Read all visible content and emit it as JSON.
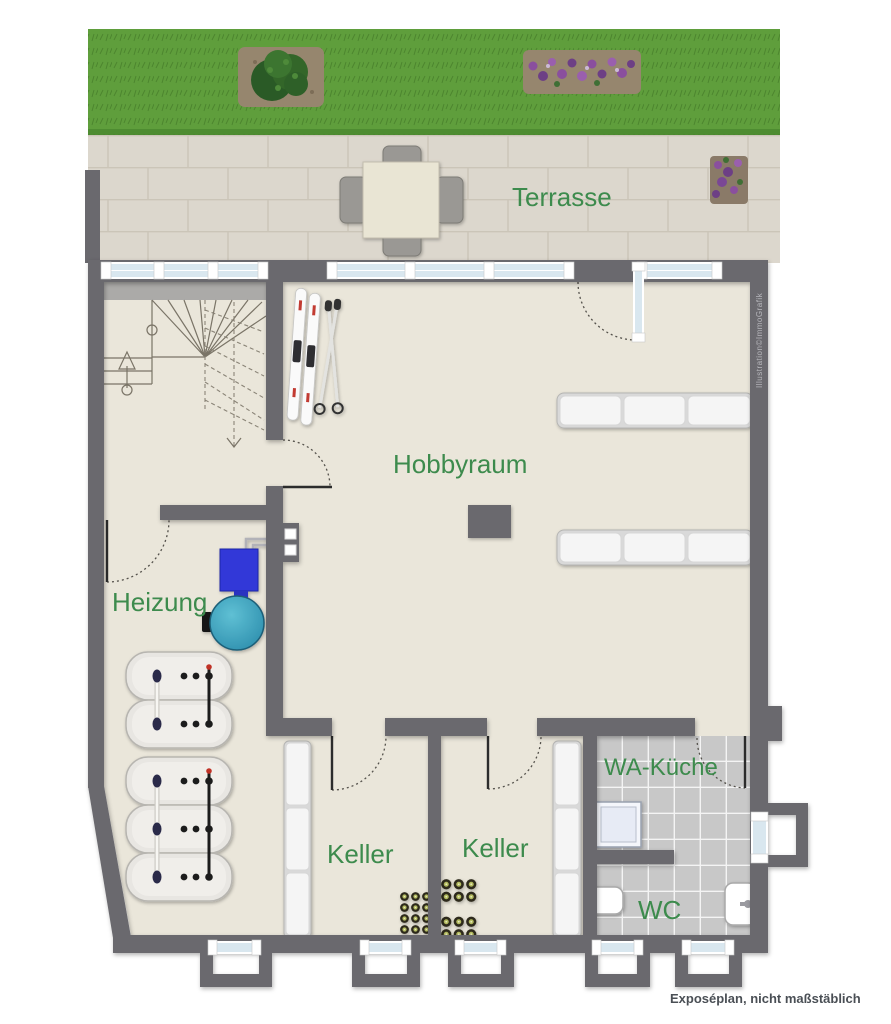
{
  "rooms": {
    "terrasse": {
      "label": "Terrasse"
    },
    "hobbyraum": {
      "label": "Hobbyraum"
    },
    "heizung": {
      "label": "Heizung"
    },
    "keller1": {
      "label": "Keller"
    },
    "keller2": {
      "label": "Keller"
    },
    "wakueche": {
      "label": "WA-Küche"
    },
    "wc": {
      "label": "WC"
    }
  },
  "annotations": {
    "credit": "Illustration©ImmoGrafik",
    "disclaimer": "Exposéplan, nicht maßstäblich"
  },
  "colors": {
    "wall": "#6a696e",
    "floor": "#eae6da",
    "room_label": "#3d8b4d",
    "lawn": "#5f9e3c",
    "paving": "#dcd7cd",
    "tile": "#c8c8c8",
    "window_glass": "#d9e7ef",
    "boiler_blue": "#3038d8",
    "tank_teal": "#2e8fae",
    "annotation_gray": "#4a4f55"
  }
}
